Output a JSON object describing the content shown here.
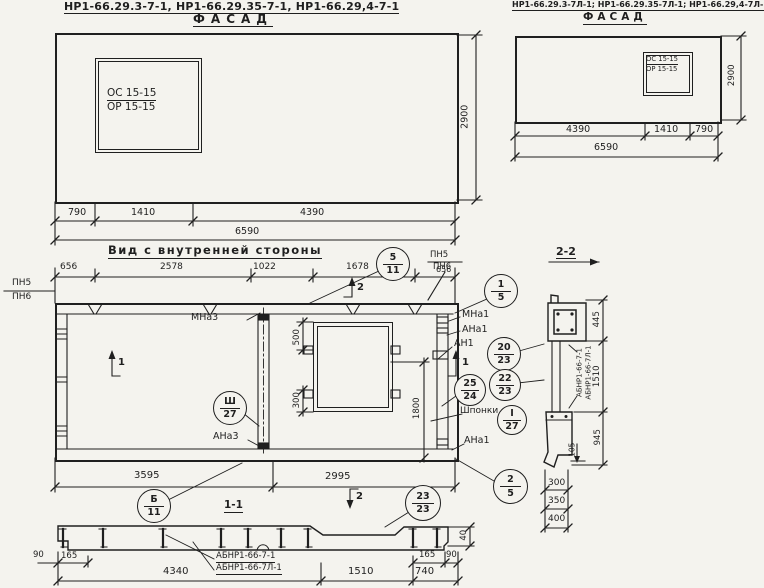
{
  "palette": {
    "paper": "#f4f3ee",
    "ink": "#1f1f1f"
  },
  "facade_left": {
    "title": "НР1-66.29.3-7-1, НР1-66.29.35-7-1, НР1-66.29,4-7-1",
    "subtitle": "Фасад",
    "window": {
      "top": "ОС 15-15",
      "bottom": "ОР 15-15"
    },
    "dims": {
      "a": "790",
      "b": "1410",
      "c": "4390",
      "total": "6590",
      "height": "2900"
    }
  },
  "facade_right": {
    "title": "НР1-66.29.3-7Л-1; НР1-66.29.35-7Л-1; НР1-66.29,4-7Л-1",
    "subtitle": "Фасад",
    "window": {
      "top": "ОС 15-15",
      "bottom": "ОР 15-15"
    },
    "dims": {
      "a": "4390",
      "b": "1410",
      "c": "790",
      "total": "6590",
      "height": "2900"
    }
  },
  "inner_view": {
    "title": "Вид с внутренней стороны",
    "top_dims": [
      "656",
      "2578",
      "1022",
      "1678",
      "656"
    ],
    "bottom_dims": [
      "3595",
      "2995"
    ],
    "window_dims": {
      "upper": "500",
      "lower": "300",
      "side": "1800"
    },
    "labels": {
      "pn5": "ПН5",
      "pn6": "ПН6",
      "mna3": "МНа3",
      "ana3": "АНа3",
      "mna1": "МНа1",
      "ana1": "АНа1",
      "an1": "АН1",
      "shponki": "Шпонки",
      "ana1_bottom": "АНа1"
    },
    "section_markers": {
      "one": "1",
      "two": "2"
    }
  },
  "callouts": {
    "c5_11": {
      "top": "5",
      "bottom": "11"
    },
    "c1_5": {
      "top": "1",
      "bottom": "5"
    },
    "c20_23": {
      "top": "20",
      "bottom": "23"
    },
    "c22_23": {
      "top": "22",
      "bottom": "23"
    },
    "c25_24": {
      "top": "25",
      "bottom": "24"
    },
    "cI_27": {
      "top": "I",
      "bottom": "27"
    },
    "cIII_27": {
      "top": "Ш",
      "bottom": "27"
    },
    "c2_5": {
      "top": "2",
      "bottom": "5"
    },
    "cB_11": {
      "top": "Б",
      "bottom": "11"
    },
    "c23_23": {
      "top": "23",
      "bottom": "23"
    }
  },
  "section_1_1": {
    "title": "1-1",
    "mark_line1": "АБНР1-66-7-1",
    "mark_line2": "АБНР1-66-7Л-1",
    "dims": {
      "left_offset": "90",
      "left_inset": "165",
      "a": "4340",
      "b": "1510",
      "c": "740",
      "right_inset": "165",
      "right_offset": "90",
      "lip": "40"
    }
  },
  "section_2_2": {
    "title": "2-2",
    "mark_line1": "АБНР1-66-7-1",
    "mark_line2": "АБНР1-66-7Л-1",
    "dims": {
      "top": "445",
      "middle": "1510",
      "bottom": "945",
      "small": "105",
      "w1": "300",
      "w2": "350",
      "w3": "400"
    }
  }
}
